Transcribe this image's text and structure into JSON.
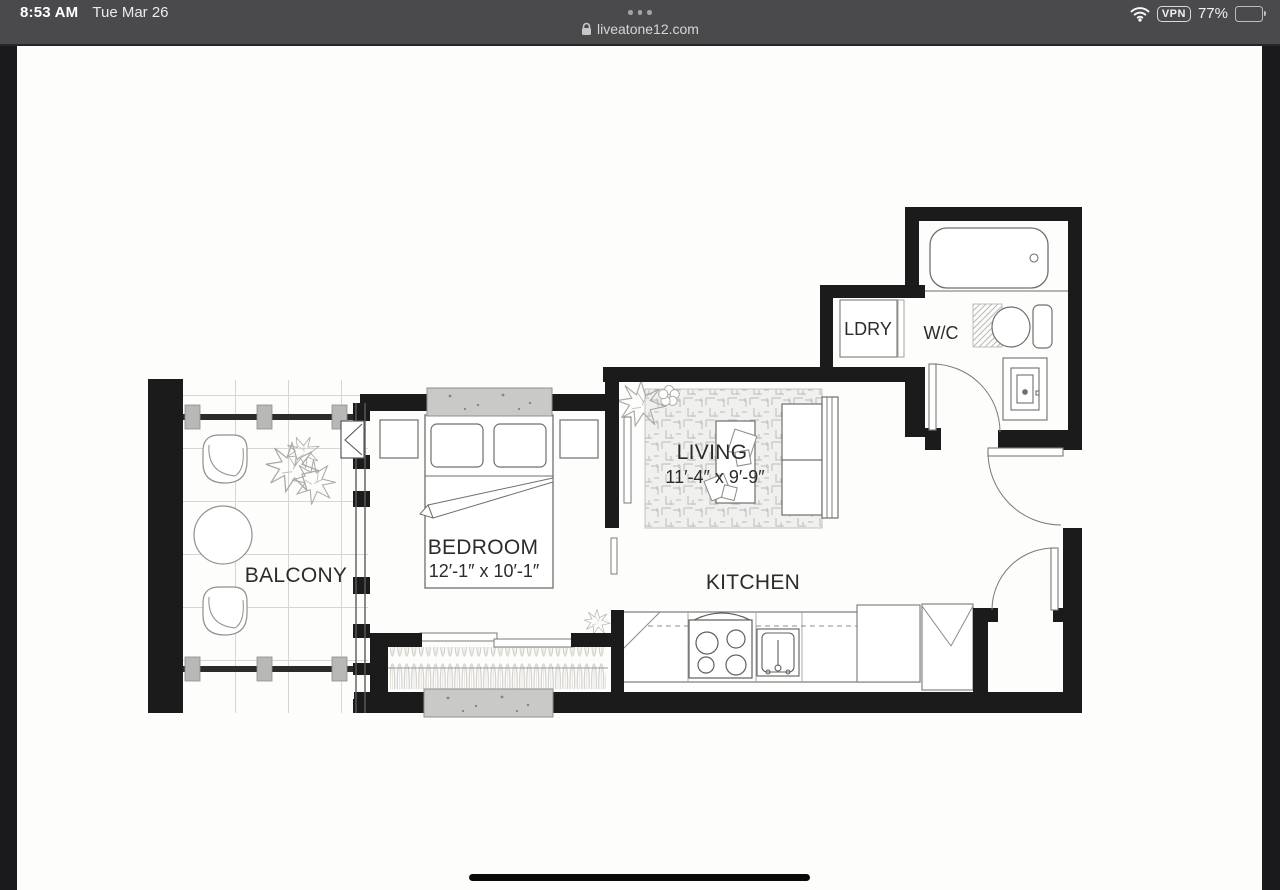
{
  "status_bar": {
    "time": "8:53 AM",
    "date": "Tue Mar 26",
    "more_options": "•••",
    "battery_percent": "77%",
    "vpn_label": "VPN"
  },
  "address_bar": {
    "domain": "liveatone12.com",
    "lock_icon": "padlock"
  },
  "floor_plan": {
    "rooms": {
      "living": {
        "name": "LIVING",
        "dimensions": "11′-4″ x 9′-9″"
      },
      "bedroom": {
        "name": "BEDROOM",
        "dimensions": "12′-1″ x 10′-1″"
      },
      "kitchen": {
        "name": "KITCHEN"
      },
      "balcony": {
        "name": "BALCONY"
      },
      "laundry": {
        "name": "LDRY"
      },
      "wc": {
        "name": "W/C"
      }
    }
  },
  "colors": {
    "wall": "#1b1b1b",
    "status_bar_bg": "#4a494b",
    "side_bars": "#1a191b",
    "gray_fixture": "#c9c9c7",
    "canvas": "#fdfdfc"
  }
}
